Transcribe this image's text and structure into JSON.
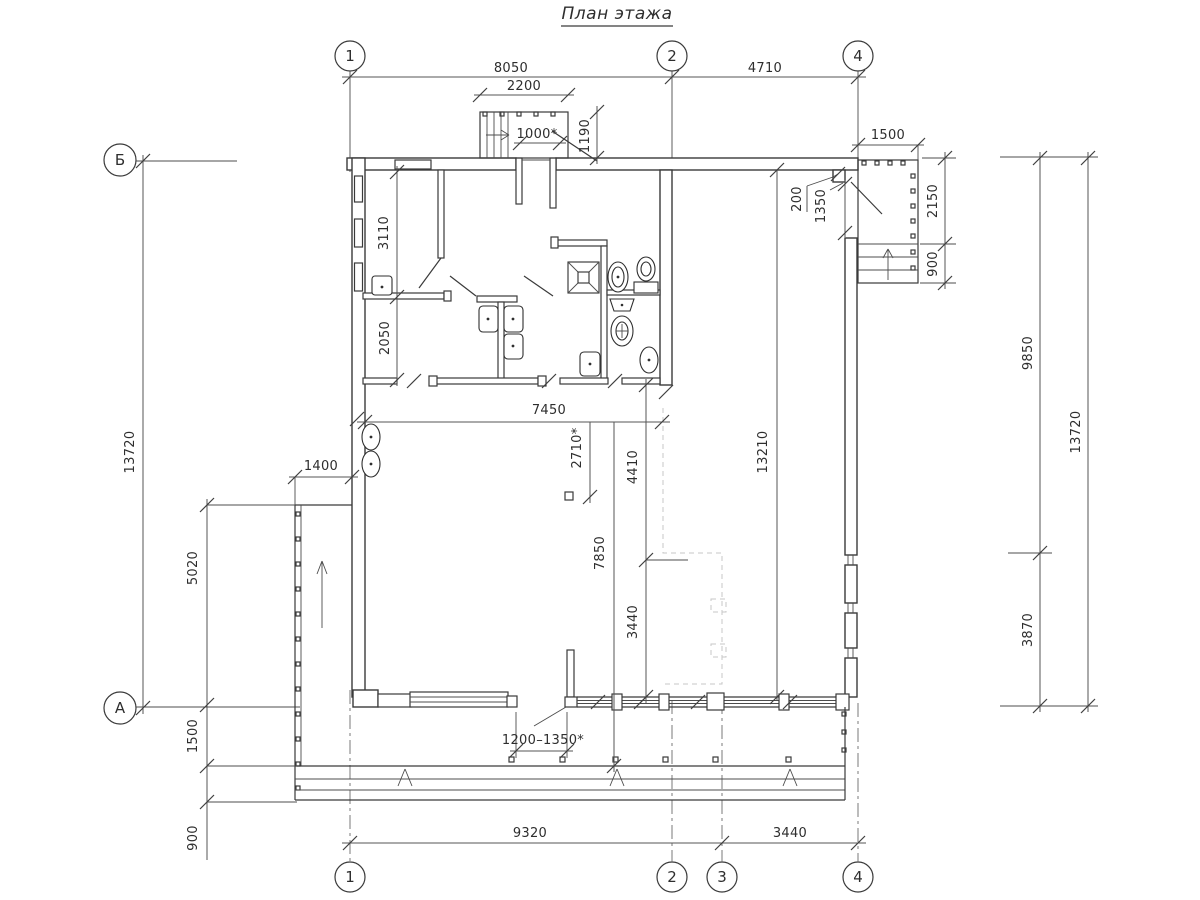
{
  "title": "План этажа",
  "axes": {
    "top": [
      "1",
      "2",
      "4"
    ],
    "bottom": [
      "1",
      "2",
      "3",
      "4"
    ],
    "left_top": "Б",
    "left_bottom": "А"
  },
  "dims": {
    "top_span1": "8050",
    "top_span2": "4710",
    "porch_width": "2200",
    "entry_door": "1000*",
    "porch_depth": "1190",
    "right_porch_width": "1500",
    "jog": "200",
    "right_door": "1350",
    "right_porch_platform": "2150",
    "right_porch_steps": "900",
    "right_upper": "9850",
    "right_total": "13720",
    "right_lower": "3870",
    "left_total": "13720",
    "room_a": "3110",
    "room_b": "2050",
    "ramp_width": "1400",
    "ramp_length": "5020",
    "terrace_left_a": "1500",
    "terrace_left_b": "900",
    "hall_width": "7450",
    "opening": "2710*",
    "hall_a": "4410",
    "hall_total": "13210",
    "hall_b": "7850",
    "hall_c": "3440",
    "terrace_entry": "1200–1350*",
    "bottom_span1": "9320",
    "bottom_span2": "3440"
  }
}
